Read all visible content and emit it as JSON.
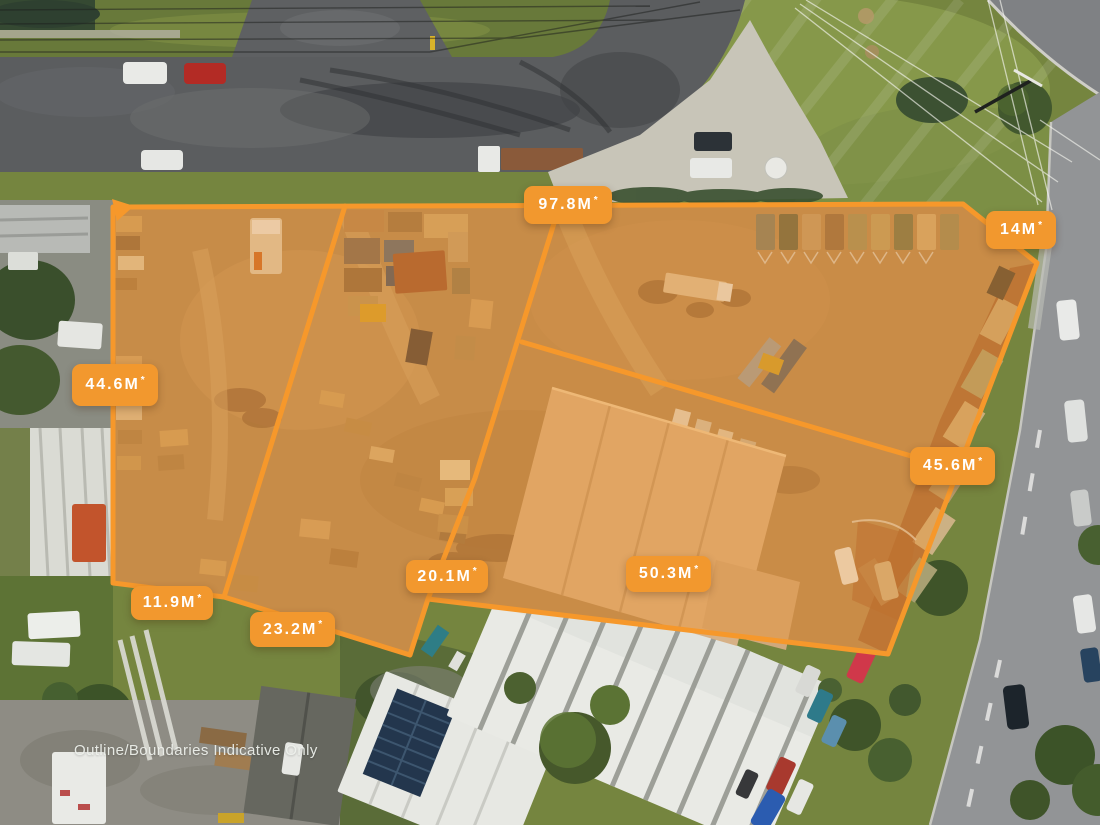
{
  "image": {
    "description": "Aerial drone photograph of industrial land parcels outlined in orange with boundary measurements",
    "disclaimer": "Outline/Boundaries Indicative Only"
  },
  "overlay": {
    "accent_color": "#F2982E",
    "boundary_color": "#F6982B",
    "parcel_fill_color": "#F2912A"
  },
  "measurements": [
    {
      "id": "boundary-top-frontage",
      "value": "97.8M",
      "suffix": "*"
    },
    {
      "id": "boundary-north-east",
      "value": "14M",
      "suffix": "*"
    },
    {
      "id": "boundary-west",
      "value": "44.6M",
      "suffix": "*"
    },
    {
      "id": "boundary-east",
      "value": "45.6M",
      "suffix": "*"
    },
    {
      "id": "boundary-inner-west",
      "value": "20.1M",
      "suffix": "*"
    },
    {
      "id": "boundary-south",
      "value": "50.3M",
      "suffix": "*"
    },
    {
      "id": "boundary-south-west",
      "value": "11.9M",
      "suffix": "*"
    },
    {
      "id": "boundary-south-middle",
      "value": "23.2M",
      "suffix": "*"
    }
  ]
}
